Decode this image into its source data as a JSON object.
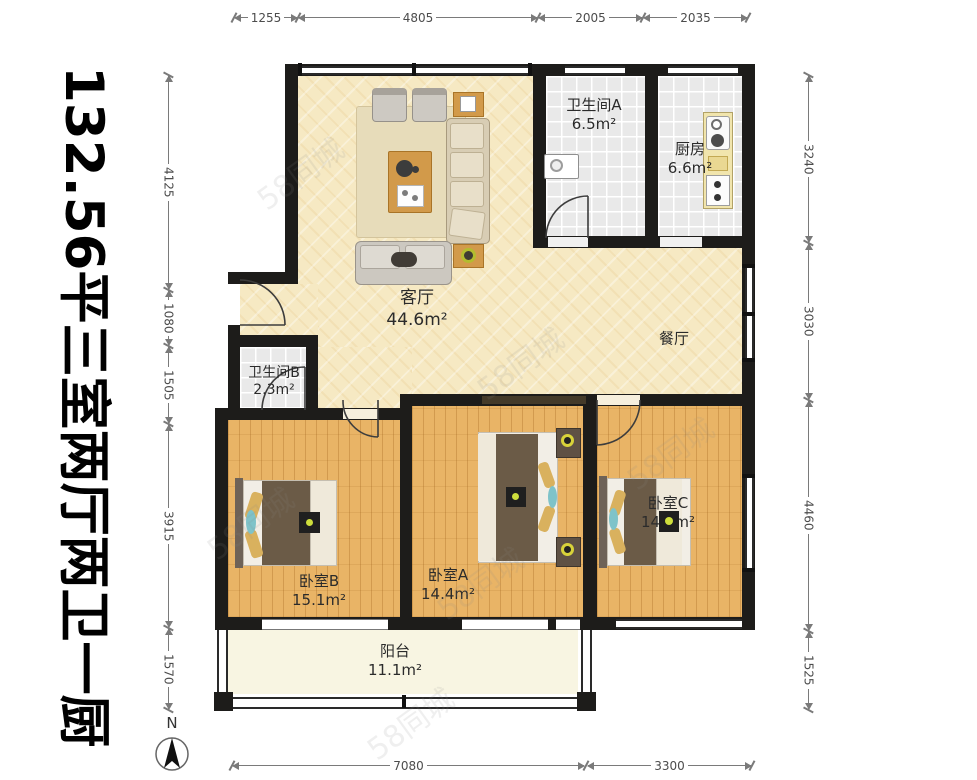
{
  "title": "132.56平三室两厅两卫一厨",
  "compass": {
    "label": "N"
  },
  "watermark": "58同城",
  "dimensions": {
    "top": [
      "1255",
      "4805",
      "2005",
      "2035"
    ],
    "left": [
      "4125",
      "1080",
      "1505",
      "3915",
      "1570"
    ],
    "right": [
      "3240",
      "3030",
      "4460",
      "1525"
    ],
    "bottom": [
      "7080",
      "3300"
    ]
  },
  "rooms": [
    {
      "name": "卫生间A",
      "area": "6.5m²"
    },
    {
      "name": "厨房",
      "area": "6.6m²"
    },
    {
      "name": "客厅",
      "area": "44.6m²"
    },
    {
      "name": "餐厅",
      "area": ""
    },
    {
      "name": "卫生间B",
      "area": "2.3m²"
    },
    {
      "name": "卧室B",
      "area": "15.1m²"
    },
    {
      "name": "卧室A",
      "area": "14.4m²"
    },
    {
      "name": "卧室C",
      "area": "14.2m²"
    },
    {
      "name": "阳台",
      "area": "11.1m²"
    }
  ],
  "colors": {
    "wall": "#1d1c1a",
    "living_floor": "#f6e9c3",
    "bedroom_floor": "#e9b466",
    "tile_floor": "#e9e9e9",
    "balcony_floor": "#f8f5e2",
    "accent_wood": "#d29a4a"
  }
}
